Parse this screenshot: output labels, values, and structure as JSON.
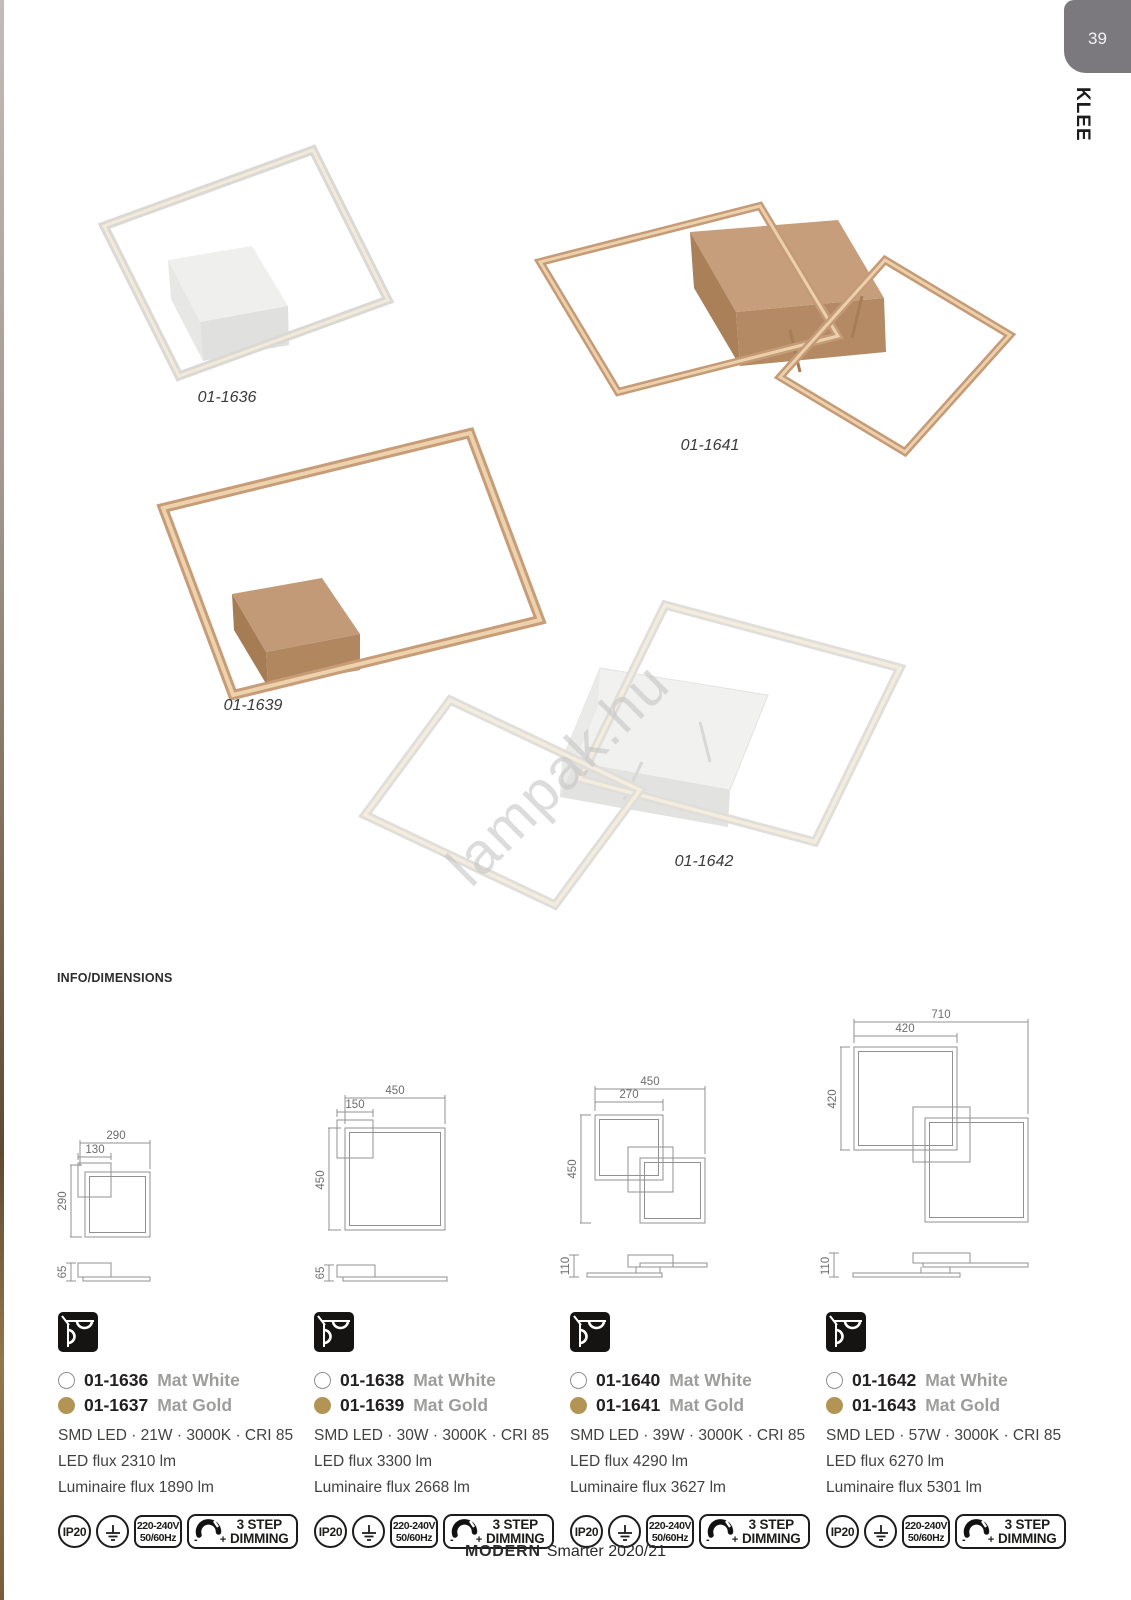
{
  "page": {
    "number": "39",
    "tab_label": "KLEE",
    "section_title": "INFO/DIMENSIONS",
    "watermark": "lampak.hu",
    "footer": {
      "brand": "MODERN",
      "rest": "Smarter 2020/21"
    }
  },
  "products": [
    {
      "label": "01-1636"
    },
    {
      "label": "01-1641"
    },
    {
      "label": "01-1639"
    },
    {
      "label": "01-1642"
    }
  ],
  "drawings": [
    {
      "total_width": "290",
      "canopy_width": "130",
      "height": "290",
      "depth": "65"
    },
    {
      "total_width": "450",
      "canopy_width": "150",
      "height": "450",
      "depth": "65"
    },
    {
      "total_width": "450",
      "canopy_width": "270",
      "height": "450",
      "depth": "110"
    },
    {
      "total_width": "710",
      "canopy_width": "420",
      "height": "420",
      "depth": "110"
    }
  ],
  "info_blocks": [
    {
      "white_code": "01-1636",
      "white_finish": "Mat White",
      "gold_code": "01-1637",
      "gold_finish": "Mat Gold",
      "specs": "SMD LED · 21W · 3000K · CRI 85",
      "led_flux": "LED flux 2310 lm",
      "luminaire_flux": "Luminaire flux 1890 lm"
    },
    {
      "white_code": "01-1638",
      "white_finish": "Mat White",
      "gold_code": "01-1639",
      "gold_finish": "Mat Gold",
      "specs": "SMD LED · 30W · 3000K · CRI 85",
      "led_flux": "LED flux 3300 lm",
      "luminaire_flux": "Luminaire flux 2668 lm"
    },
    {
      "white_code": "01-1640",
      "white_finish": "Mat White",
      "gold_code": "01-1641",
      "gold_finish": "Mat Gold",
      "specs": "SMD LED · 39W · 3000K · CRI 85",
      "led_flux": "LED flux 4290 lm",
      "luminaire_flux": "Luminaire flux 3627 lm"
    },
    {
      "white_code": "01-1642",
      "white_finish": "Mat White",
      "gold_code": "01-1643",
      "gold_finish": "Mat Gold",
      "specs": "SMD LED · 57W · 3000K · CRI 85",
      "led_flux": "LED flux 6270 lm",
      "luminaire_flux": "Luminaire flux 5301 lm"
    }
  ],
  "badges": {
    "ip": "IP20",
    "voltage_line1": "220-240V",
    "voltage_line2": "50/60Hz",
    "dim_minus": "-",
    "dim_plus": "+",
    "dim_line1": "3 STEP",
    "dim_line2": "DIMMING"
  },
  "colors": {
    "gold_frame": "#c49a76",
    "white_frame": "#dedcd8",
    "glow": "#f2e6cf",
    "gold_dot": "#b29455",
    "tab_bg": "#7b797e"
  }
}
